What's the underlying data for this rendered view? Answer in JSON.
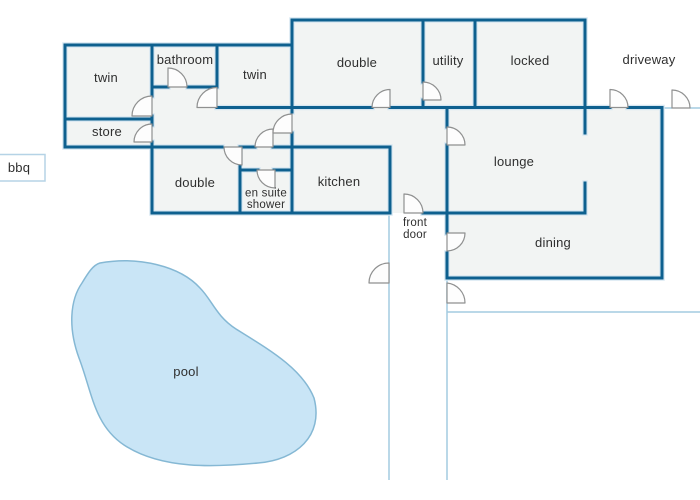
{
  "diagram": {
    "type": "house-floor-plan",
    "colors": {
      "wall": "#0e608f",
      "wall_halo": "#d7e7f2",
      "room_fill": "#f2f4f3",
      "fence_line": "#a4cbe0",
      "pool_fill": "#c9e5f6",
      "pool_stroke": "#85b8d4",
      "door_arc_stroke": "#8f9090",
      "label_text": "#2f2f2f",
      "bbq_box_border": "#b5d3e6"
    }
  },
  "rooms": {
    "twin_front": {
      "label": "twin"
    },
    "bathroom": {
      "label": "bathroom"
    },
    "twin_mid": {
      "label": "twin"
    },
    "store": {
      "label": "store"
    },
    "double_front": {
      "label": "double"
    },
    "utility": {
      "label": "utility"
    },
    "locked": {
      "label": "locked"
    },
    "double_back": {
      "label": "double"
    },
    "en_suite": {
      "label_line1": "en suite",
      "label_line2": "shower"
    },
    "kitchen": {
      "label": "kitchen"
    },
    "lounge": {
      "label": "lounge"
    },
    "dining": {
      "label": "dining"
    }
  },
  "outdoor": {
    "driveway": {
      "label": "driveway"
    },
    "bbq": {
      "label": "bbq"
    },
    "front_door": {
      "label_line1": "front",
      "label_line2": "door"
    },
    "pool": {
      "label": "pool"
    }
  }
}
